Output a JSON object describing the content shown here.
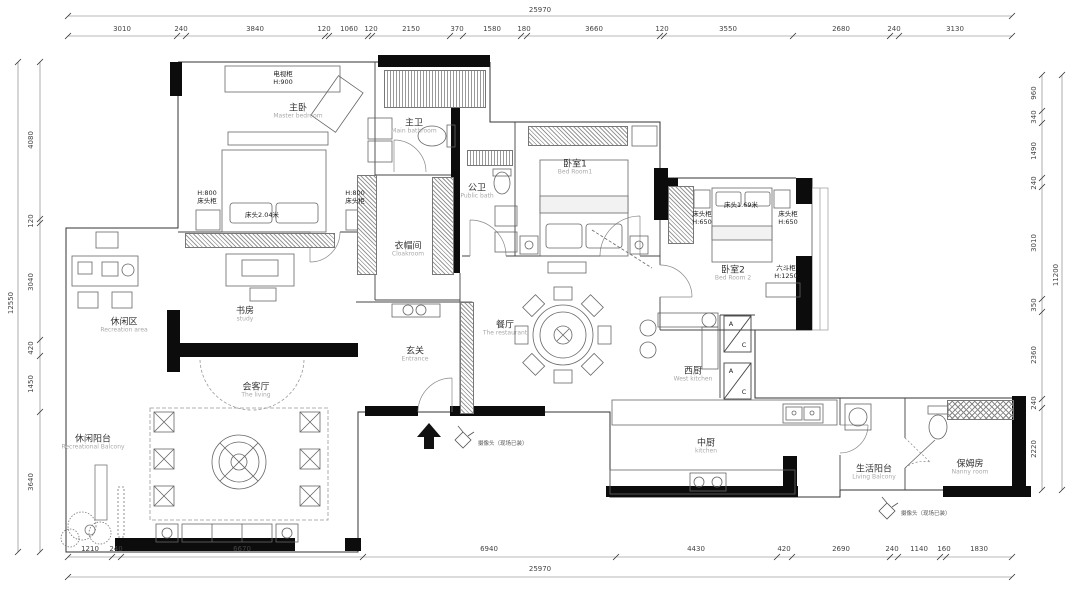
{
  "dims": {
    "overall_top": "25970",
    "overall_bottom": "25970",
    "overall_left": "12550",
    "overall_right": "11200",
    "top": [
      "3010",
      "240",
      "3840",
      "120",
      "1060",
      "120",
      "2150",
      "370",
      "1580",
      "180",
      "3660",
      "120",
      "3550",
      "2680",
      "240",
      "3130"
    ],
    "bottom": [
      "1210",
      "240",
      "6670",
      "6940",
      "4430",
      "420",
      "2690",
      "240",
      "1140",
      "160",
      "1830"
    ],
    "left": [
      "4080",
      "120",
      "3040",
      "420",
      "1450",
      "3640"
    ],
    "right": [
      "960",
      "340",
      "1490",
      "240",
      "3010",
      "350",
      "2360",
      "240",
      "2220"
    ]
  },
  "rooms": {
    "master_bedroom": {
      "zh": "主卧",
      "en": "Master bedroom"
    },
    "master_bath": {
      "zh": "主卫",
      "en": "Main bathroom"
    },
    "cloakroom": {
      "zh": "衣帽间",
      "en": "Cloakroom"
    },
    "public_bath": {
      "zh": "公卫",
      "en": "Public bath"
    },
    "bedroom1": {
      "zh": "卧室1",
      "en": "Bed Room1"
    },
    "bedroom2": {
      "zh": "卧室2",
      "en": "Bed Room 2"
    },
    "leisure_area": {
      "zh": "休闲区",
      "en": "Recreation area"
    },
    "study": {
      "zh": "书房",
      "en": "study"
    },
    "reception": {
      "zh": "会客厅",
      "en": "The living"
    },
    "entrance": {
      "zh": "玄关",
      "en": "Entrance"
    },
    "dining": {
      "zh": "餐厅",
      "en": "The restaurant"
    },
    "west_kitchen": {
      "zh": "西厨",
      "en": "West kitchen"
    },
    "main_kitchen": {
      "zh": "中厨",
      "en": "kitchen"
    },
    "living_balcony": {
      "zh": "生活阳台",
      "en": "Living Balcony"
    },
    "leisure_balcony": {
      "zh": "休闲阳台",
      "en": "Recreational Balcony"
    },
    "nanny_room": {
      "zh": "保姆房",
      "en": "Nanny room"
    }
  },
  "furniture": {
    "tv_cabinet": {
      "name": "电视柜",
      "h": "H:900"
    },
    "nightstand_master": {
      "h": "H:800",
      "name": "床头柜"
    },
    "bed_master": "床头2.04米",
    "bed_2": "床头1.69米",
    "nightstand_b2": {
      "name": "床头柜",
      "h": "H:650"
    },
    "six_drawer": {
      "name": "六斗柜",
      "h": "H:1250"
    },
    "ac_a": "A",
    "ac_c": "C",
    "camera_note": "摄像头（现场已装）"
  }
}
